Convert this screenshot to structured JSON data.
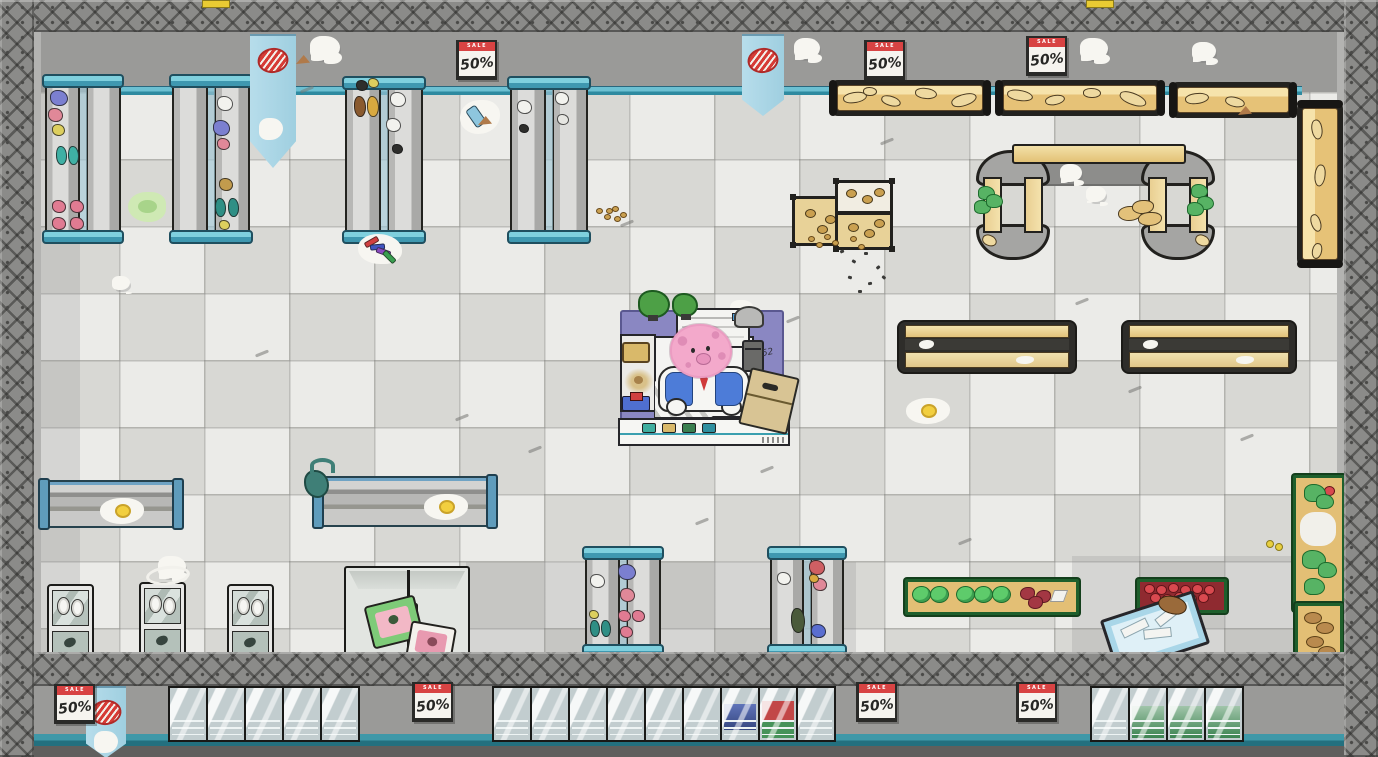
{
  "meta": {
    "scene": "supermarket-top-down",
    "style": "cartoon-cleaning-game"
  },
  "palette": {
    "wall": "#9a9a98",
    "frame": "#8b8b89",
    "floor_light": "#ebebe8",
    "floor_dark": "#d8d8d4",
    "teal": "#55aec2",
    "teal_dark": "#2e8aa0",
    "banner_blue": "#aad6e6",
    "mat_purple": "#8a87c2",
    "accent_red": "#d84343",
    "bakery_tan": "#e6c277",
    "produce_green": "#1e5f2c",
    "character_pink": "#f3a9cb"
  },
  "signs": {
    "sale": {
      "header": "SALE",
      "value": "50%"
    },
    "positions": [
      [
        456,
        40
      ],
      [
        864,
        40
      ],
      [
        1026,
        36
      ],
      [
        54,
        684
      ],
      [
        412,
        682
      ],
      [
        856,
        682
      ],
      [
        1016,
        682
      ]
    ]
  },
  "checkout": {
    "scribble": "52",
    "belt_items": [
      "#3fae9f",
      "#d9b96a",
      "#3a7f4f",
      "#2e8f9f"
    ]
  },
  "banners": [
    [
      250,
      34,
      46,
      132,
      1
    ],
    [
      742,
      34,
      42,
      80,
      0
    ],
    [
      86,
      686,
      40,
      70,
      1
    ]
  ],
  "tabs": [
    202,
    1086
  ],
  "freezers": {
    "y": 686,
    "w": 36,
    "h": 52,
    "step": 38,
    "groups": [
      {
        "x": 168,
        "contents": [
          null,
          null,
          null,
          null,
          null
        ]
      },
      {
        "x": 492,
        "contents": [
          null,
          null,
          null,
          null,
          null,
          null,
          "blue",
          "redgreen",
          null
        ]
      },
      {
        "x": 1090,
        "contents": [
          null,
          "greens",
          "greens",
          "greens"
        ]
      }
    ]
  },
  "patches": [
    [
      34,
      92,
      46,
      560
    ],
    [
      466,
      562,
      390,
      90
    ],
    [
      1072,
      556,
      272,
      96
    ]
  ],
  "entities": [
    {
      "t": "shelfv",
      "x": 44,
      "y": 74,
      "w": 78,
      "h": 170,
      "products": [
        [
          6,
          16,
          "#7b7fd0",
          16,
          0
        ],
        [
          4,
          34,
          "#e08898",
          13,
          0
        ],
        [
          8,
          50,
          "#ddcf5e",
          11,
          0
        ],
        [
          12,
          72,
          "#3fb0a4",
          9,
          1
        ],
        [
          24,
          72,
          "#3fb0a4",
          9,
          1
        ],
        [
          8,
          126,
          "#e07b92",
          12,
          0
        ],
        [
          26,
          126,
          "#e07b92",
          12,
          0
        ],
        [
          8,
          143,
          "#e07b92",
          12,
          0
        ],
        [
          26,
          143,
          "#e07b92",
          12,
          0
        ]
      ]
    },
    {
      "t": "shelfv",
      "x": 171,
      "y": 74,
      "w": 80,
      "h": 170,
      "products": [
        [
          46,
          22,
          "#f2f2ee",
          14,
          0
        ],
        [
          42,
          46,
          "#7b7fd0",
          15,
          0
        ],
        [
          46,
          64,
          "#e08898",
          11,
          0
        ],
        [
          48,
          104,
          "#c29b4d",
          12,
          0
        ],
        [
          44,
          124,
          "#2f8f85",
          9,
          1
        ],
        [
          57,
          124,
          "#2f8f85",
          9,
          1
        ],
        [
          48,
          146,
          "#ddcf5e",
          9,
          0
        ]
      ]
    },
    {
      "t": "shelfv",
      "x": 344,
      "y": 76,
      "w": 80,
      "h": 168,
      "products": [
        [
          12,
          4,
          "#2e2e2c",
          10,
          0
        ],
        [
          24,
          2,
          "#ddcf5e",
          9,
          0
        ],
        [
          10,
          20,
          "#8a5a2f",
          10,
          1
        ],
        [
          23,
          20,
          "#d9a93f",
          10,
          1
        ],
        [
          46,
          16,
          "#f2f2ee",
          14,
          0
        ],
        [
          42,
          42,
          "#f2f2ee",
          13,
          0
        ],
        [
          48,
          68,
          "#2e2e2c",
          9,
          0
        ]
      ]
    },
    {
      "t": "shelfv",
      "x": 509,
      "y": 76,
      "w": 80,
      "h": 168,
      "products": [
        [
          8,
          24,
          "#f2f2ee",
          13,
          0
        ],
        [
          46,
          16,
          "#f2f2ee",
          12,
          0
        ],
        [
          48,
          38,
          "#e6e6e2",
          10,
          0
        ],
        [
          10,
          48,
          "#2e2e2c",
          8,
          0
        ]
      ]
    },
    {
      "t": "shelfv",
      "x": 584,
      "y": 546,
      "w": 78,
      "h": 112,
      "products": [
        [
          6,
          28,
          "#f2f2ee",
          13,
          0
        ],
        [
          34,
          18,
          "#7b7fd0",
          16,
          0
        ],
        [
          36,
          42,
          "#e08898",
          13,
          0
        ],
        [
          34,
          64,
          "#e07b92",
          11,
          0
        ],
        [
          48,
          64,
          "#e07b92",
          11,
          0
        ],
        [
          36,
          80,
          "#e07b92",
          11,
          0
        ],
        [
          6,
          74,
          "#2f8f85",
          8,
          1
        ],
        [
          17,
          74,
          "#2f8f85",
          8,
          1
        ],
        [
          5,
          64,
          "#ddcf5e",
          8,
          0
        ]
      ]
    },
    {
      "t": "shelfv",
      "x": 769,
      "y": 546,
      "w": 76,
      "h": 112,
      "products": [
        [
          8,
          26,
          "#f2f2ee",
          12,
          0
        ],
        [
          40,
          14,
          "#cf5f63",
          14,
          0
        ],
        [
          44,
          32,
          "#e08898",
          12,
          0
        ],
        [
          40,
          28,
          "#d9a93f",
          8,
          0
        ],
        [
          22,
          62,
          "#4a5a3a",
          12,
          1
        ],
        [
          42,
          78,
          "#5a6ed0",
          13,
          0
        ]
      ]
    },
    {
      "t": "shelfh",
      "x": 40,
      "y": 480,
      "w": 138,
      "h": 44
    },
    {
      "t": "shelfh",
      "x": 314,
      "y": 476,
      "w": 178,
      "h": 47
    },
    {
      "t": "bakh",
      "x": 829,
      "y": 80,
      "w": 162,
      "h": 36,
      "items": [
        [
          14,
          12,
          22,
          9,
          -10
        ],
        [
          52,
          16,
          18,
          8,
          15
        ],
        [
          86,
          8,
          20,
          9,
          5
        ],
        [
          122,
          14,
          24,
          10,
          -18
        ],
        [
          34,
          7,
          12,
          7,
          0
        ]
      ]
    },
    {
      "t": "bakh",
      "x": 995,
      "y": 80,
      "w": 170,
      "h": 36,
      "items": [
        [
          12,
          10,
          24,
          9,
          8
        ],
        [
          50,
          15,
          18,
          8,
          -12
        ],
        [
          88,
          8,
          16,
          8,
          0
        ],
        [
          124,
          13,
          26,
          10,
          20
        ]
      ]
    },
    {
      "t": "bakh",
      "x": 1169,
      "y": 82,
      "w": 128,
      "h": 36,
      "items": [
        [
          16,
          11,
          22,
          9,
          -8
        ],
        [
          56,
          15,
          18,
          8,
          12
        ]
      ]
    },
    {
      "t": "bakv",
      "x": 1297,
      "y": 100,
      "w": 46,
      "h": 168,
      "items": [
        [
          10,
          24,
          18,
          9,
          80
        ],
        [
          12,
          70,
          20,
          9,
          95
        ],
        [
          10,
          118,
          16,
          8,
          70
        ],
        [
          12,
          146,
          14,
          8,
          100
        ]
      ]
    },
    {
      "t": "archshadow",
      "x": 1022,
      "y": 160,
      "w": 150,
      "h": 24
    },
    {
      "t": "archbar",
      "x": 1012,
      "y": 144,
      "w": 170,
      "h": 16
    },
    {
      "t": "arch",
      "x": 974,
      "y": 150,
      "w": 78,
      "h": 110,
      "leafs": [
        [
          4,
          36
        ],
        [
          0,
          50
        ],
        [
          12,
          44
        ]
      ]
    },
    {
      "t": "arch",
      "x": 1139,
      "y": 150,
      "w": 78,
      "h": 110,
      "leafs": [
        [
          52,
          34
        ],
        [
          58,
          46
        ],
        [
          48,
          52
        ]
      ]
    },
    {
      "t": "bakh2",
      "x": 897,
      "y": 320,
      "w": 176,
      "h": 50
    },
    {
      "t": "bakh2",
      "x": 1121,
      "y": 320,
      "w": 172,
      "h": 50
    },
    {
      "t": "crate",
      "x": 792,
      "y": 196,
      "w": 68,
      "h": 44
    },
    {
      "t": "crate2",
      "x": 835,
      "y": 180,
      "w": 52,
      "h": 64
    },
    {
      "t": "fridgev",
      "x": 47,
      "y": 584,
      "w": 43,
      "h": 74
    },
    {
      "t": "fridgev",
      "x": 139,
      "y": 582,
      "w": 43,
      "h": 74
    },
    {
      "t": "fridgev",
      "x": 227,
      "y": 584,
      "w": 43,
      "h": 74
    },
    {
      "t": "fridged",
      "x": 344,
      "y": 566,
      "w": 122,
      "h": 88
    },
    {
      "t": "prodh",
      "x": 905,
      "y": 579,
      "w": 168,
      "h": 30,
      "kind": "cabbage"
    },
    {
      "t": "prodh",
      "x": 1137,
      "y": 579,
      "w": 84,
      "h": 28,
      "kind": "apples"
    },
    {
      "t": "cart",
      "x": 1106,
      "y": 604,
      "w": 92,
      "h": 50
    },
    {
      "t": "prodv",
      "x": 1293,
      "y": 475,
      "w": 46,
      "h": 130,
      "kind": "greens"
    },
    {
      "t": "prodv",
      "x": 1295,
      "y": 603,
      "w": 42,
      "h": 58,
      "kind": "bread"
    }
  ],
  "decals": [
    [
      "ghost",
      310,
      36,
      30
    ],
    [
      "ghost",
      794,
      38,
      26
    ],
    [
      "ghost",
      1080,
      38,
      28
    ],
    [
      "ghost",
      1192,
      42,
      24
    ],
    [
      "ghost",
      138,
      686,
      26
    ],
    [
      "ghost",
      1064,
      686,
      26
    ],
    [
      "ghost",
      1258,
      686,
      22
    ],
    [
      "ghost",
      158,
      556,
      28
    ],
    [
      "ghost",
      730,
      300,
      24
    ],
    [
      "ghost",
      1060,
      164,
      22
    ],
    [
      "ghost",
      1086,
      186,
      20
    ],
    [
      "ghost",
      112,
      276,
      18
    ],
    [
      "egg",
      100,
      498
    ],
    [
      "egg",
      424,
      494
    ],
    [
      "egg",
      906,
      398
    ],
    [
      "green",
      128,
      192
    ],
    [
      "crayons",
      358,
      234
    ],
    [
      "bottle",
      460,
      100
    ],
    [
      "shoe",
      256,
      110
    ],
    [
      "ring",
      146,
      566
    ],
    [
      "spill",
      298,
      460
    ],
    [
      "crumbs",
      594,
      204,
      30
    ],
    [
      "crumbs",
      806,
      232,
      62
    ],
    [
      "specks",
      838,
      248,
      52,
      48
    ],
    [
      "ydots",
      1266,
      540
    ],
    [
      "pile",
      1118,
      200
    ],
    [
      "brown",
      1158,
      596
    ],
    [
      "wedge",
      296,
      55
    ],
    [
      "wedge",
      478,
      116
    ],
    [
      "wedge",
      1238,
      106
    ],
    [
      "scuff",
      300,
      88
    ],
    [
      "scuff",
      554,
      168
    ],
    [
      "scuff",
      620,
      222
    ],
    [
      "scuff",
      760,
      468
    ],
    [
      "scuff",
      786,
      318
    ],
    [
      "scuff",
      528,
      448
    ],
    [
      "scuff",
      1240,
      436
    ],
    [
      "scuff",
      1128,
      388
    ],
    [
      "scuff",
      958,
      540
    ],
    [
      "scuff",
      695,
      520
    ],
    [
      "scuff",
      255,
      352
    ],
    [
      "scuff",
      455,
      416
    ],
    [
      "scuff",
      880,
      140
    ],
    [
      "scuff",
      1075,
      300
    ]
  ]
}
